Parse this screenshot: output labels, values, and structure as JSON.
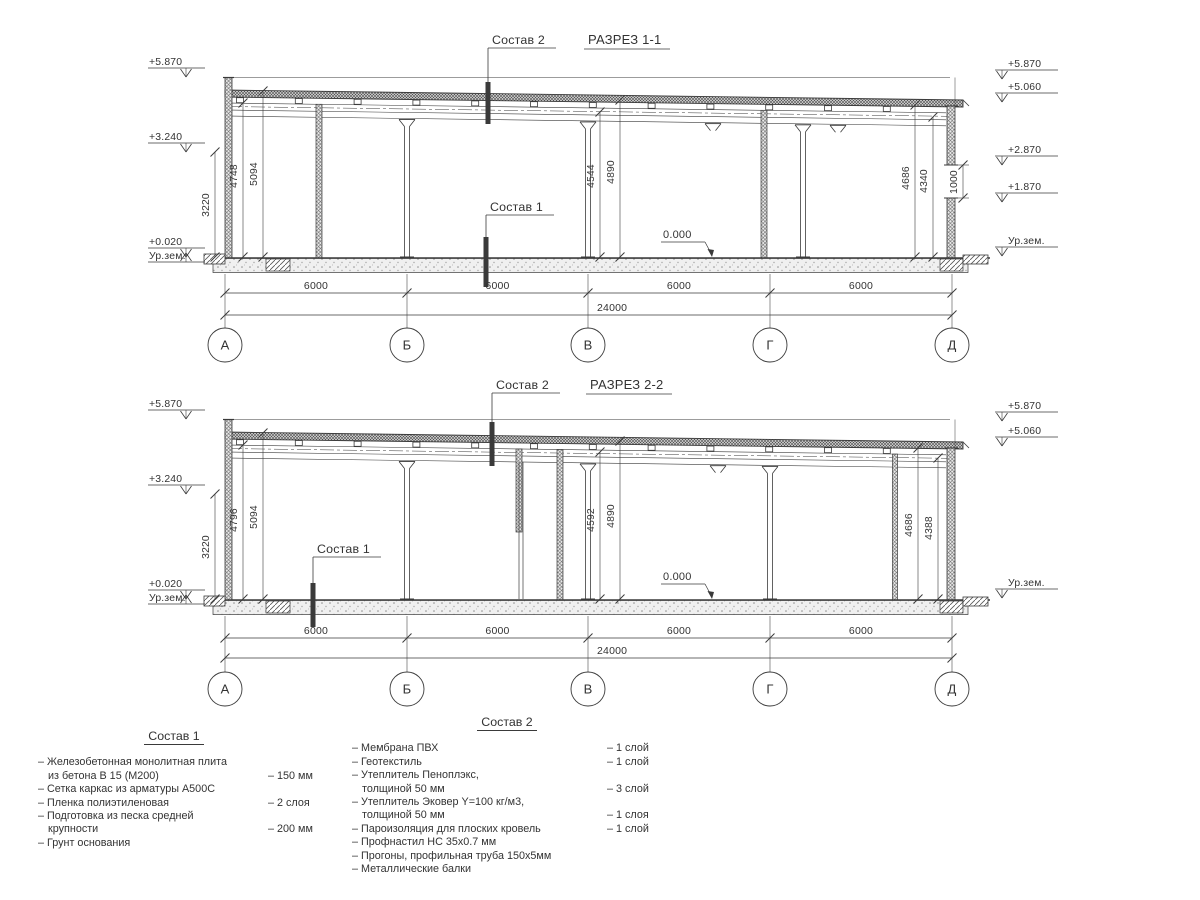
{
  "drawing_type": "building-sections",
  "sections": [
    {
      "title": "РАЗРЕЗ 1-1",
      "callout_roof": "Состав 2",
      "callout_floor": "Состав 1",
      "zero_mark": "0.000",
      "levels_left": [
        "+5.870",
        "+3.240",
        "+0.020",
        "Ур.зем."
      ],
      "levels_right": [
        "+5.870",
        "+5.060",
        "+2.870",
        "+1.870",
        "Ур.зем."
      ],
      "dims_left": [
        "3220",
        "4748",
        "5094"
      ],
      "dims_mid": [
        "4544",
        "4890"
      ],
      "dims_right": [
        "4686",
        "4340"
      ],
      "dim_window": "1000",
      "dims_bottom": [
        "6000",
        "6000",
        "6000",
        "6000"
      ],
      "dim_total": "24000",
      "axes": [
        "А",
        "Б",
        "В",
        "Г",
        "Д"
      ]
    },
    {
      "title": "РАЗРЕЗ 2-2",
      "callout_roof": "Состав 2",
      "callout_floor": "Состав 1",
      "zero_mark": "0.000",
      "levels_left": [
        "+5.870",
        "+3.240",
        "+0.020",
        "Ур.зем."
      ],
      "levels_right": [
        "+5.870",
        "+5.060",
        "Ур.зем."
      ],
      "dims_left": [
        "3220",
        "4796",
        "5094"
      ],
      "dims_mid": [
        "4592",
        "4890"
      ],
      "dims_right": [
        "4686",
        "4388"
      ],
      "dim_window": null,
      "dims_bottom": [
        "6000",
        "6000",
        "6000",
        "6000"
      ],
      "dim_total": "24000",
      "axes": [
        "А",
        "Б",
        "В",
        "Г",
        "Д"
      ]
    }
  ],
  "legends": [
    {
      "title": "Состав 1",
      "items": [
        {
          "lines": [
            "– Железобетонная  монолитная плита",
            "из бетона В 15 (М200)"
          ],
          "value": "– 150 мм"
        },
        {
          "lines": [
            "– Сетка каркас из арматуры А500С"
          ],
          "value": ""
        },
        {
          "lines": [
            "– Пленка полиэтиленовая"
          ],
          "value": "– 2 слоя"
        },
        {
          "lines": [
            "– Подготовка из песка средней",
            "крупности"
          ],
          "value": "– 200 мм"
        },
        {
          "lines": [
            "– Грунт основания"
          ],
          "value": ""
        }
      ]
    },
    {
      "title": "Состав 2",
      "items": [
        {
          "lines": [
            "– Мембрана ПВХ"
          ],
          "value": "– 1 слой"
        },
        {
          "lines": [
            "– Геотекстиль"
          ],
          "value": "– 1 слой"
        },
        {
          "lines": [
            "– Утеплитель Пеноплэкс,",
            "толщиной 50 мм"
          ],
          "value": "– 3 слой"
        },
        {
          "lines": [
            "– Утеплитель Эковер Y=100 кг/м3,",
            "толщиной 50 мм"
          ],
          "value": "– 1 слоя"
        },
        {
          "lines": [
            "– Пароизоляция для плоских кровель"
          ],
          "value": "– 1 слой"
        },
        {
          "lines": [
            "– Профнастил НС 35х0.7 мм"
          ],
          "value": ""
        },
        {
          "lines": [
            "– Прогоны, профильная труба 150х5мм"
          ],
          "value": ""
        },
        {
          "lines": [
            "– Металлические балки"
          ],
          "value": ""
        }
      ]
    }
  ]
}
